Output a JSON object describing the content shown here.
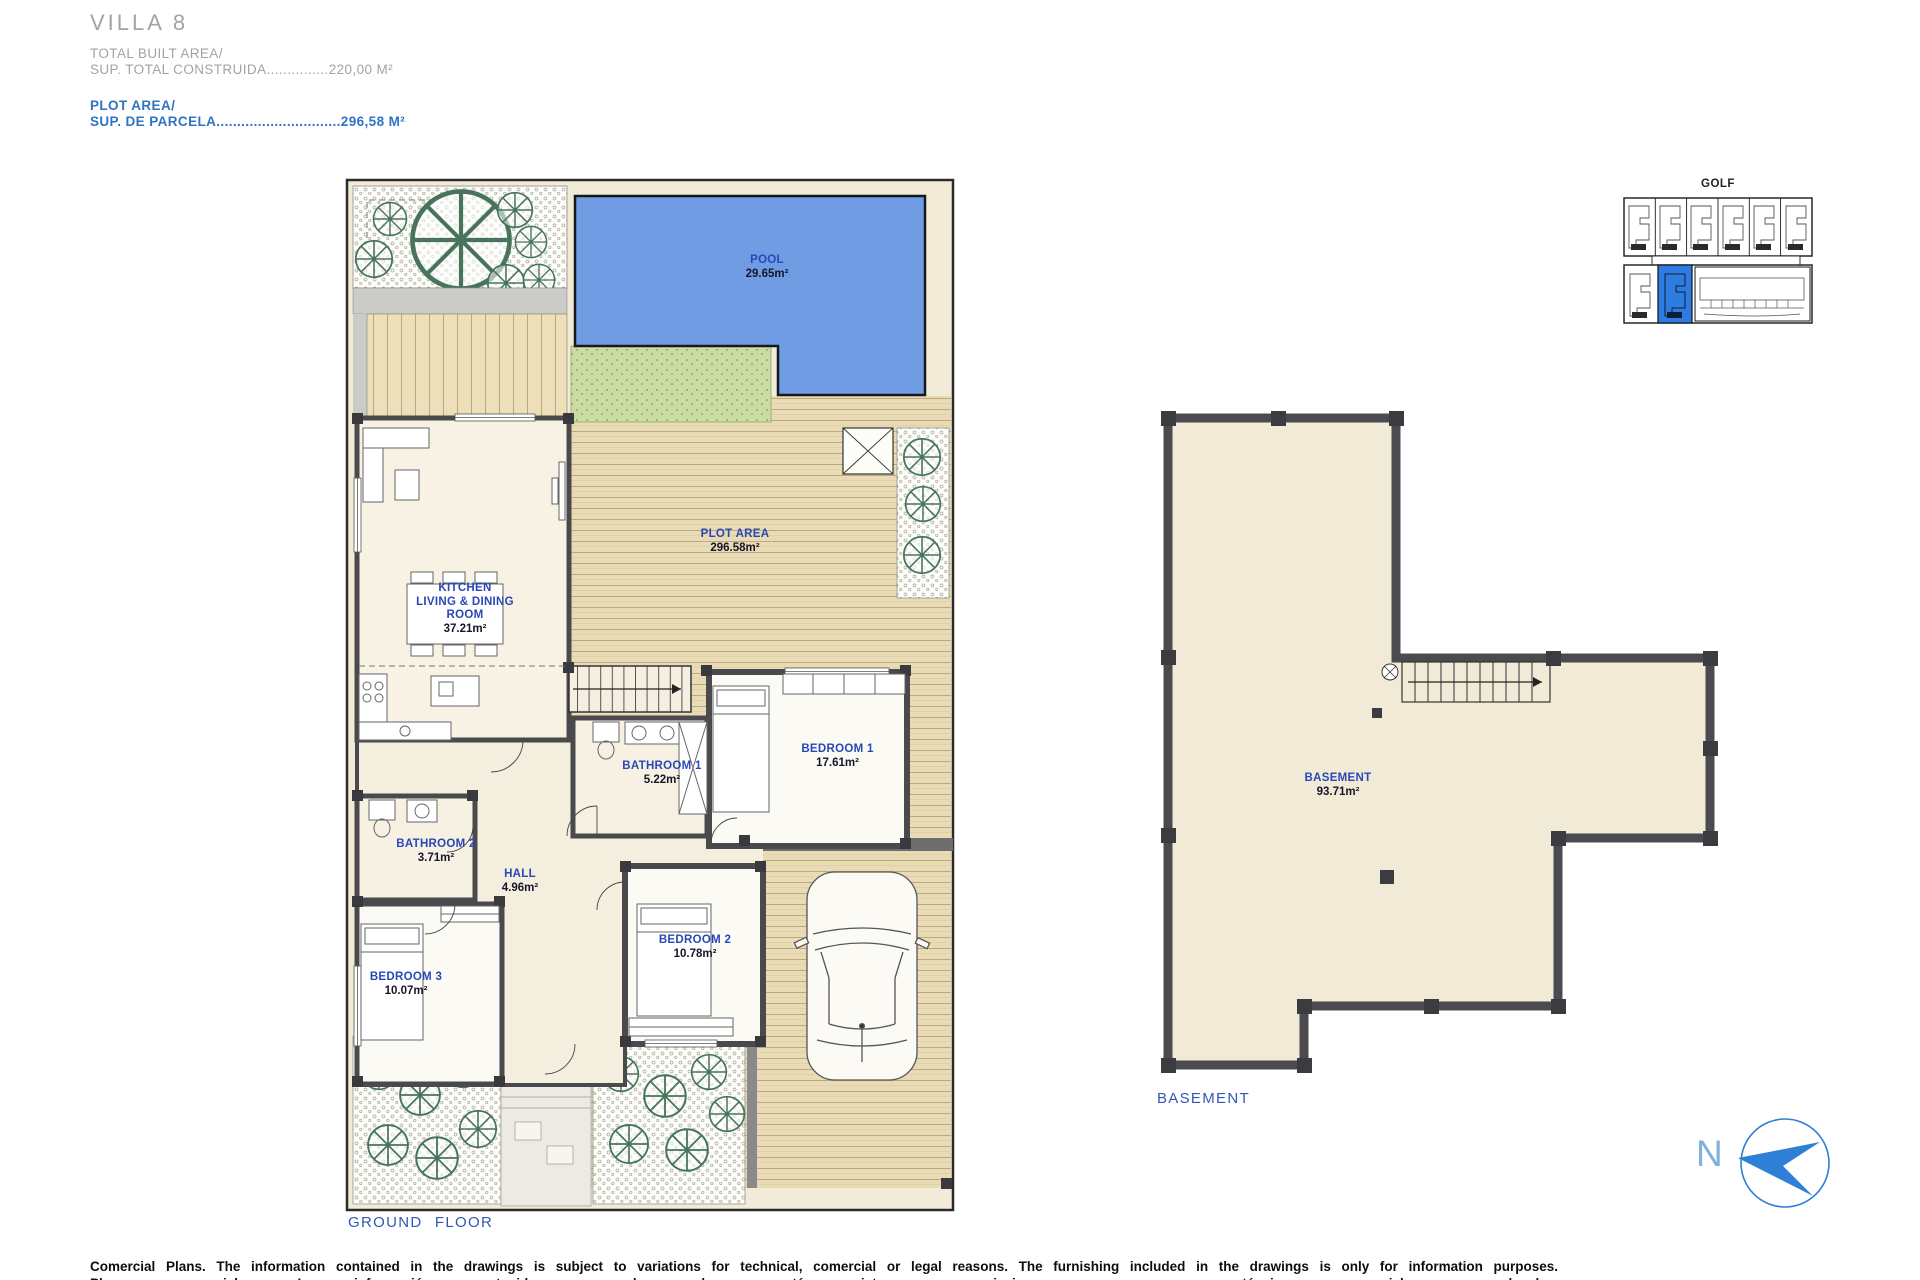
{
  "header": {
    "title": "VILLA 8",
    "total_built_area_label": "TOTAL BUILT AREA/",
    "total_built_area_value": "SUP. TOTAL CONSTRUIDA...............220,00 M²",
    "plot_area_label": "PLOT AREA/",
    "plot_area_value": "SUP. DE PARCELA..............................296,58 M²"
  },
  "ground_floor": {
    "caption": "GROUND FLOOR",
    "labels": {
      "pool": {
        "name": "POOL",
        "area": "29.65m²"
      },
      "plot": {
        "name": "PLOT AREA",
        "area": "296.58m²"
      },
      "kitchen": {
        "line1": "KITCHEN",
        "line2": "LIVING & DINING",
        "line3": "ROOM",
        "area": "37.21m²"
      },
      "bathroom1": {
        "name": "BATHROOM 1",
        "area": "5.22m²"
      },
      "bedroom1": {
        "name": "BEDROOM 1",
        "area": "17.61m²"
      },
      "bathroom2": {
        "name": "BATHROOM 2",
        "area": "3.71m²"
      },
      "hall": {
        "name": "HALL",
        "area": "4.96m²"
      },
      "bedroom2": {
        "name": "BEDROOM 2",
        "area": "10.78m²"
      },
      "bedroom3": {
        "name": "BEDROOM 3",
        "area": "10.07m²"
      }
    }
  },
  "basement": {
    "caption": "BASEMENT",
    "label": {
      "name": "BASEMENT",
      "area": "93.71m²"
    }
  },
  "key_plan": {
    "title": "GOLF"
  },
  "compass": {
    "north_label": "N"
  },
  "footer": {
    "line1": "Comercial Plans. The information contained in the drawings is subject to variations for technical, comercial or legal reasons. The furnishing included in the drawings is only for information purposes.",
    "line2_partial": "Planos comerciales. La información contenida en los planos está sujeta a variaciones por razones técnicas, comerciales o legales."
  },
  "colors": {
    "pool_blue": "#6f9ce2",
    "label_blue": "#2948b8",
    "header_blue": "#2e74c4",
    "header_gray": "#9fa4a8",
    "deck_tan": "#e7d8b2",
    "grass_green": "#cbdba4",
    "wall_gray": "#4a4a4c",
    "compass_blue": "#2e7fd6",
    "keyplan_highlight": "#2f7ce0"
  }
}
